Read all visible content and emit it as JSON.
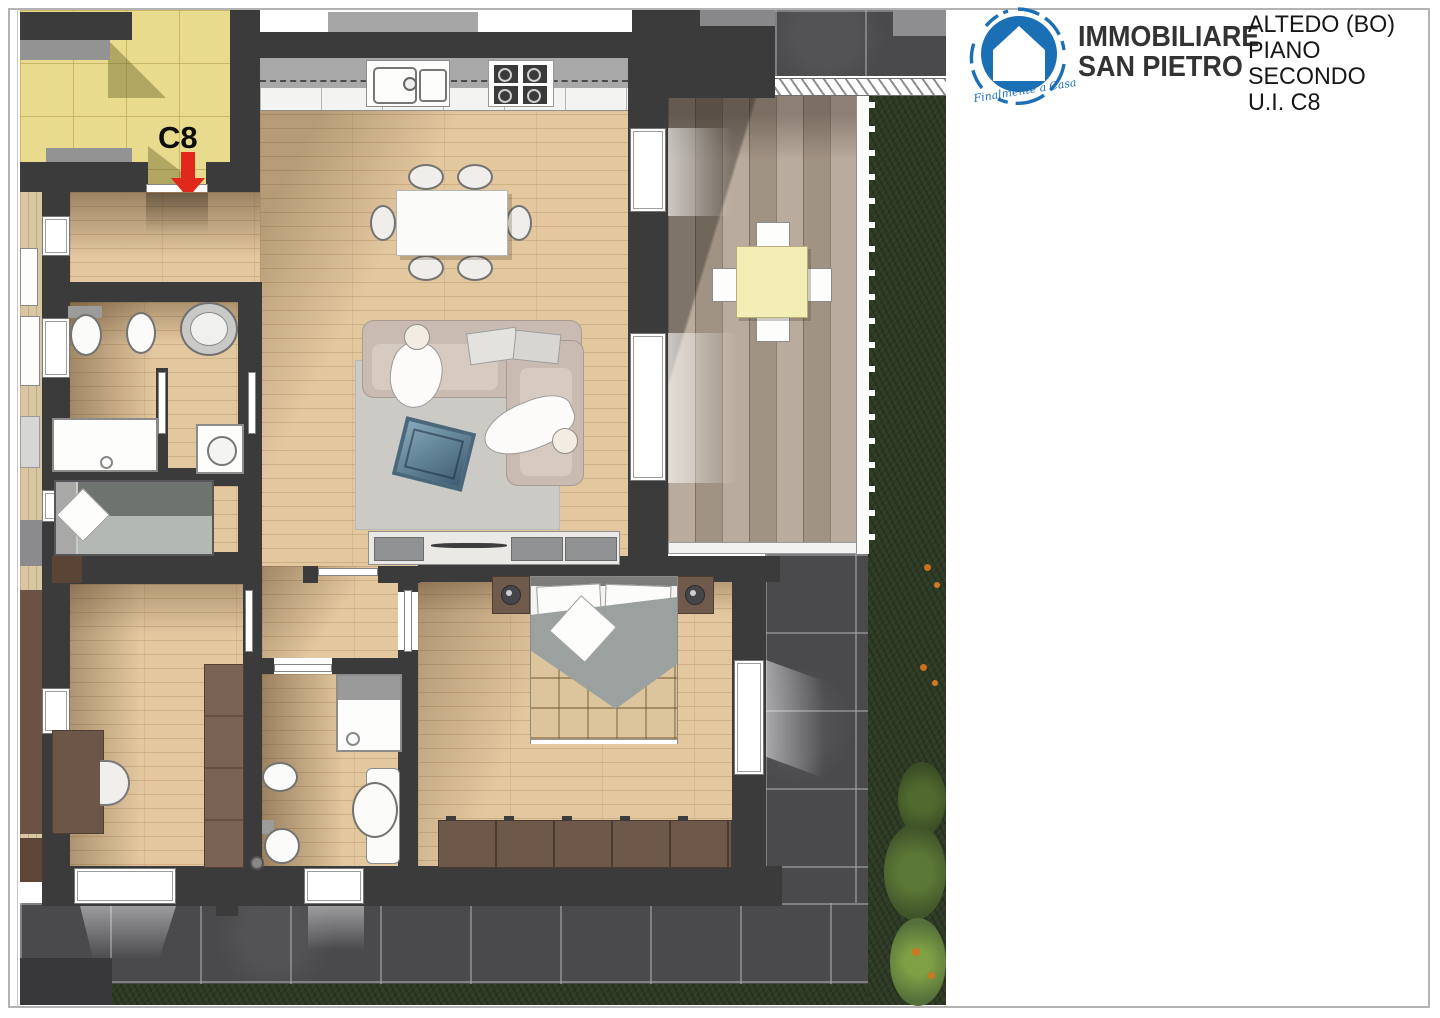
{
  "title_block": {
    "brand": {
      "line1": "IMMOBILIARE",
      "line2": "SAN PIETRO",
      "tagline": "Finalmente a Casa"
    },
    "location": {
      "line1": "ALTEDO (BO)",
      "line2": "PIANO SECONDO",
      "line3": "U.I. C8"
    }
  },
  "plan": {
    "unit_label": "C8",
    "colors": {
      "logo_blue": "#1b6fb5",
      "entrance_arrow_red": "#e0281b",
      "wall": "#3b3b3c",
      "wood_floor": "#e2c79f",
      "stairwell_tile": "#e9db8e",
      "terrace_deck": "#b2a394",
      "stone_paving": "#4a4a4d",
      "grass": "#2e3a25",
      "outdoor_table_yellow": "#f3edb6"
    }
  }
}
